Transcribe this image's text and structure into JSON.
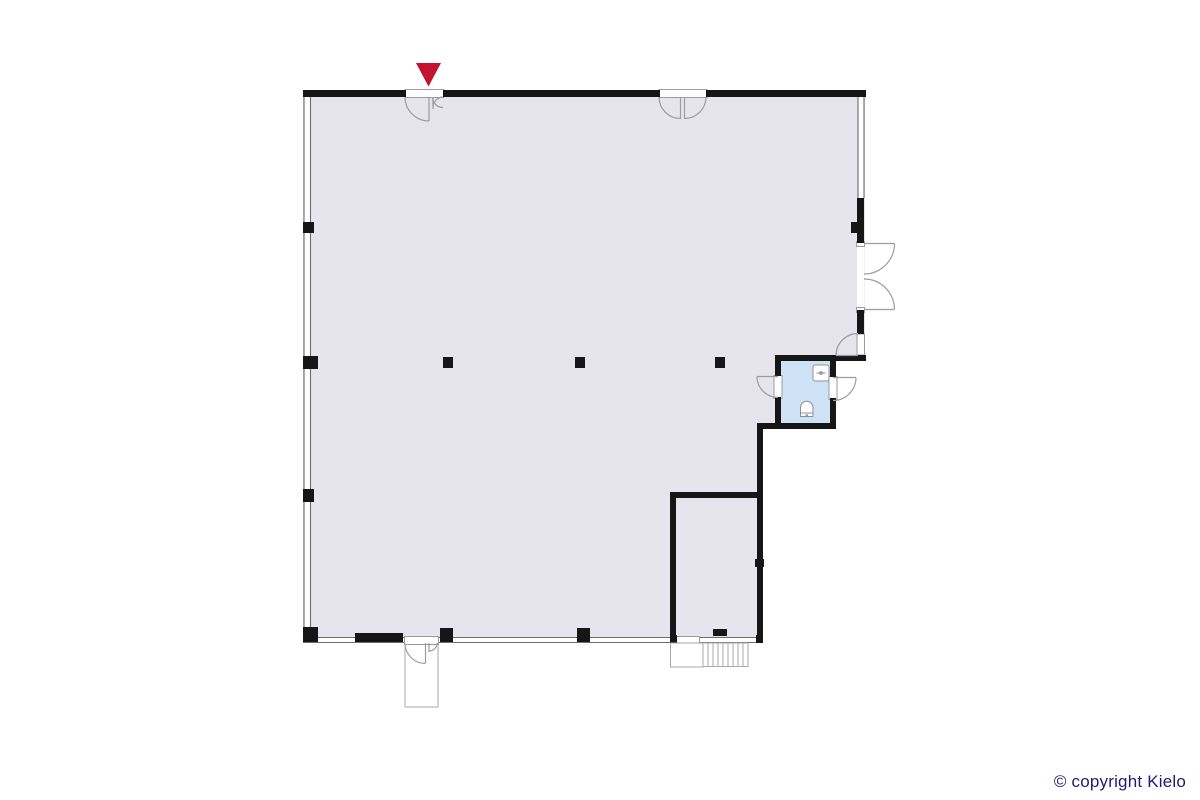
{
  "footer": {
    "copyright": "© copyright Kielo"
  },
  "colors": {
    "background": "#ffffff",
    "floor": "#e6e5ed",
    "wc_floor": "#cde2f5",
    "wall": "#161616",
    "thin": "#6b6b74",
    "door": "#9b9ba4",
    "stair": "#a9a9b0",
    "fixture": "#8f8f98",
    "marker": "#c41331",
    "copyright_text": "#1c1c72"
  },
  "plan": {
    "entrance_marker_icon": "red-arrow-down-icon",
    "fixture_icons": [
      "sink-icon",
      "toilet-icon",
      "stairs-icon"
    ],
    "door_count": 8,
    "column_count": 3
  }
}
